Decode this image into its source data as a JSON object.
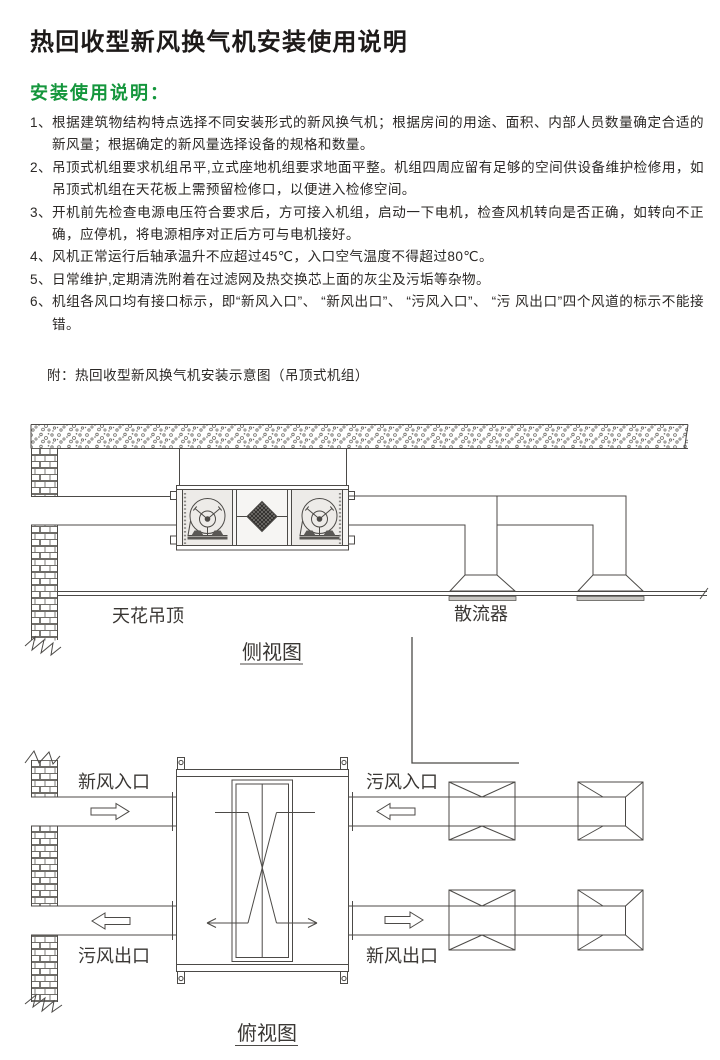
{
  "document": {
    "title": "热回收型新风换气机安装使用说明",
    "section_heading": "安装使用说明：",
    "instructions": [
      {
        "marker": "1、",
        "text": "根据建筑物结构特点选择不同安装形式的新风换气机；根据房间的用途、面积、内部人员数量确定合适的新风量；根据确定的新风量选择设备的规格和数量。"
      },
      {
        "marker": "2、",
        "text": "吊顶式机组要求机组吊平,立式座地机组要求地面平整。机组四周应留有足够的空间供设备维护检修用，如吊顶式机组在天花板上需预留检修口，以便进入检修空间。"
      },
      {
        "marker": "3、",
        "text": "开机前先检查电源电压符合要求后，方可接入机组，启动一下电机，检查风机转向是否正确，如转向不正确，应停机，将电源相序对正后方可与电机接好。"
      },
      {
        "marker": "4、",
        "text": "风机正常运行后轴承温升不应超过45℃，入口空气温度不得超过80℃。"
      },
      {
        "marker": "5、",
        "text": "日常维护,定期清洗附着在过滤网及热交换芯上面的灰尘及污垢等杂物。"
      },
      {
        "marker": "6、",
        "text": "机组各风口均有接口标示，即“新风入口”、 “新风出口”、 “污风入口”、 “污 风出口”四个风道的标示不能接错。"
      }
    ],
    "appendix_note": "附：热回收型新风换气机安装示意图（吊顶式机组）"
  },
  "diagram": {
    "side_view": {
      "title": "侧视图",
      "ceiling_label": "天花吊顶",
      "diffuser_label": "散流器"
    },
    "top_view": {
      "title": "俯视图",
      "fresh_air_inlet": "新风入口",
      "foul_air_inlet": "污风入口",
      "foul_air_outlet": "污风出口",
      "fresh_air_outlet": "新风出口"
    }
  },
  "colors": {
    "heading_green": "#14963c",
    "line": "#4c4a47",
    "body_text": "#2b2826"
  }
}
